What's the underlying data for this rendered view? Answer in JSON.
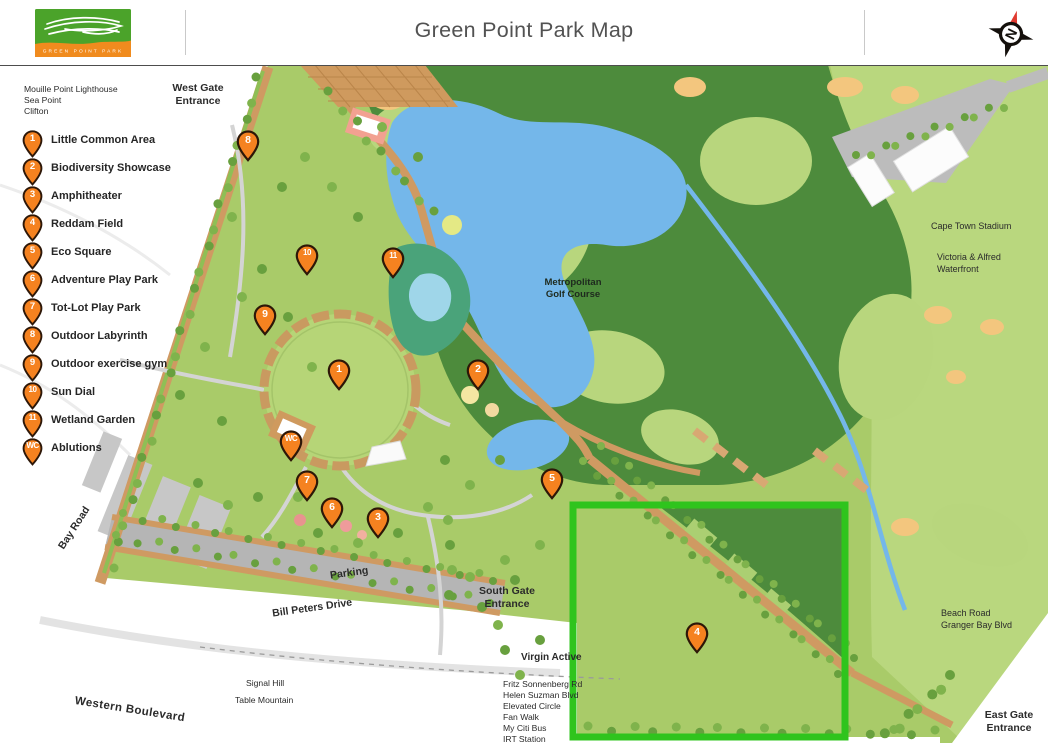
{
  "header": {
    "title": "Green Point Park Map",
    "logo_text": "GREEN POINT PARK",
    "compass_letter": "N"
  },
  "legend": {
    "items": [
      {
        "id": "1",
        "label": "Little Common Area"
      },
      {
        "id": "2",
        "label": "Biodiversity Showcase"
      },
      {
        "id": "3",
        "label": "Amphitheater"
      },
      {
        "id": "4",
        "label": "Reddam Field"
      },
      {
        "id": "5",
        "label": "Eco Square"
      },
      {
        "id": "6",
        "label": "Adventure Play Park"
      },
      {
        "id": "7",
        "label": "Tot-Lot Play Park"
      },
      {
        "id": "8",
        "label": "Outdoor Labyrinth"
      },
      {
        "id": "9",
        "label": "Outdoor exercise gym"
      },
      {
        "id": "10",
        "label": "Sun Dial"
      },
      {
        "id": "11",
        "label": "Wetland Garden"
      },
      {
        "id": "WC",
        "label": "Ablutions"
      }
    ]
  },
  "markers": [
    {
      "id": "1",
      "x": 339,
      "y": 372
    },
    {
      "id": "2",
      "x": 478,
      "y": 372
    },
    {
      "id": "3",
      "x": 378,
      "y": 520
    },
    {
      "id": "4",
      "x": 697,
      "y": 635
    },
    {
      "id": "5",
      "x": 552,
      "y": 481
    },
    {
      "id": "6",
      "x": 332,
      "y": 510
    },
    {
      "id": "7",
      "x": 307,
      "y": 483
    },
    {
      "id": "8",
      "x": 248,
      "y": 143
    },
    {
      "id": "9",
      "x": 265,
      "y": 317
    },
    {
      "id": "10",
      "x": 307,
      "y": 257
    },
    {
      "id": "11",
      "x": 393,
      "y": 260
    },
    {
      "id": "WC",
      "x": 291,
      "y": 443
    }
  ],
  "labels": {
    "nearby_west": "Mouille Point Lighthouse\nSea Point\nClifton",
    "west_gate": "West Gate\nEntrance",
    "cape_town_stadium": "Cape Town Stadium",
    "va_waterfront": "Victoria & Alfred\nWaterfront",
    "golf_course": "Metropolitan\nGolf Course",
    "bay_road": "Bay Road",
    "parking": "Parking",
    "bill_peters": "Bill Peters Drive",
    "south_gate": "South Gate\nEntrance",
    "virgin_active": "Virgin Active",
    "transport_list": "Fritz Sonnenberg Rd\nHelen Suzman Blvd\nElevated Circle\nFan  Walk\nMy Citi Bus\nIRT Station",
    "signal_hill": "Signal Hill",
    "table_mountain": "Table Mountain",
    "western_boulevard": "Western Boulevard",
    "beach_road": "Beach Road\nGranger Bay Blvd",
    "east_gate": "East Gate\nEntrance"
  },
  "colors": {
    "pin_orange": "#f58220",
    "highlight_green": "#2fc41d",
    "park_green": "#a9cb69",
    "golf_green": "#4d8b3c",
    "water_blue": "#74b7ea",
    "path_tan": "#cf9a62"
  }
}
